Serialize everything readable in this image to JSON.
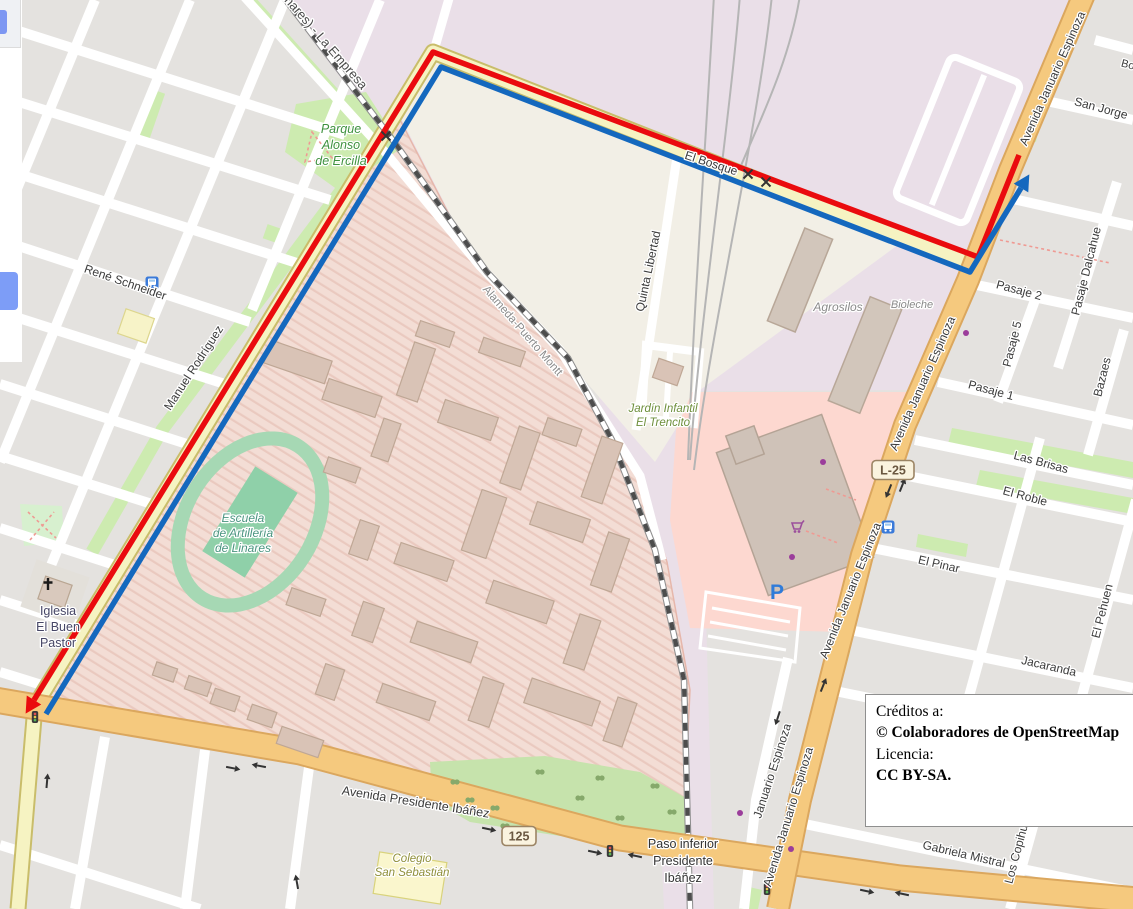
{
  "page": {
    "width": 1133,
    "height": 909,
    "description": "OpenStreetMap route map, Linares, Chile"
  },
  "credits": {
    "line1": "Créditos a:",
    "line2": "© Colaboradores de OpenStreetMap",
    "line3": "Licencia:",
    "line4": "CC BY-SA."
  },
  "map": {
    "palette": {
      "route_outbound_blue": "#1468be",
      "route_return_red": "#ea0b0e",
      "road_primary_orange": "#f5c97e",
      "road_secondary_yellow": "#f6f3c2",
      "grass_green": "#cdebb0",
      "military_pink": "#f3ddd5",
      "retail_pink": "#fdd8d0",
      "railway_lavender": "#eadfe8",
      "commercial_beige": "#f2efe6",
      "block_gray": "#e4e2df"
    },
    "route": {
      "red_points": [
        [
          1019,
          155
        ],
        [
          978,
          257
        ],
        [
          433,
          52
        ],
        [
          34,
          700
        ]
      ],
      "blue_points": [
        [
          46,
          714
        ],
        [
          441,
          67
        ],
        [
          970,
          272
        ],
        [
          1021,
          188
        ]
      ],
      "red_arrow_end": true,
      "blue_arrow_end": true,
      "stroke_width": 5.5
    },
    "shields": [
      {
        "label": "125",
        "x": 519,
        "y": 836
      },
      {
        "label": "L-25",
        "x": 893,
        "y": 470
      }
    ],
    "labels": [
      {
        "name": "railway-la-empresa",
        "lines": [
          "(Linares) - La Empresa"
        ],
        "x": 318,
        "y": 40,
        "rot": 49,
        "size": 13,
        "color": "#4a4a4a"
      },
      {
        "name": "street-rene-schneider",
        "lines": [
          "René Schneider"
        ],
        "x": 124,
        "y": 286,
        "rot": 19,
        "size": 12,
        "color": "#3c3c3c"
      },
      {
        "name": "street-manuel-rodriguez",
        "lines": [
          "Manuel Rodríguez"
        ],
        "x": 197,
        "y": 370,
        "rot": -57,
        "size": 12,
        "color": "#3c3c3c"
      },
      {
        "name": "park-alonso-de-ercilla",
        "lines": [
          "Parque",
          "Alonso",
          "de Ercilla"
        ],
        "x": 341,
        "y": 133,
        "rot": 0,
        "size": 12.5,
        "color": "#3f923f",
        "italic": true,
        "lh": 16
      },
      {
        "name": "street-el-bosque",
        "lines": [
          "El Bosque"
        ],
        "x": 710,
        "y": 167,
        "rot": 18,
        "size": 12,
        "color": "#3c3c3c"
      },
      {
        "name": "street-quinta-libertad",
        "lines": [
          "Quinta Libertad"
        ],
        "x": 652,
        "y": 272,
        "rot": -78,
        "size": 12,
        "color": "#3c3c3c"
      },
      {
        "name": "street-alameda-puerto-montt",
        "lines": [
          "Alameda-Puerto Montt"
        ],
        "x": 520,
        "y": 333,
        "rot": 49,
        "size": 11.5,
        "color": "#8a8a8a"
      },
      {
        "name": "poi-jardin-infantil",
        "lines": [
          "Jardín Infantil",
          "El Trencito"
        ],
        "x": 663,
        "y": 412,
        "rot": 0,
        "size": 11.5,
        "color": "#6e8f3c",
        "italic": true,
        "lh": 14
      },
      {
        "name": "poi-agrosilos",
        "lines": [
          "Agrosilos"
        ],
        "x": 838,
        "y": 311,
        "rot": 0,
        "size": 12,
        "color": "#8a8a8a",
        "italic": true
      },
      {
        "name": "poi-bioleche",
        "lines": [
          "Bioleche"
        ],
        "x": 912,
        "y": 308,
        "rot": 0,
        "size": 11,
        "color": "#8a8a8a",
        "italic": true
      },
      {
        "name": "poi-escuela-artilleria",
        "lines": [
          "Escuela",
          "de Artillería",
          "de Linares"
        ],
        "x": 243,
        "y": 522,
        "rot": 0,
        "size": 12,
        "color": "#4a9580",
        "italic": true,
        "lh": 15
      },
      {
        "name": "poi-iglesia-buen-pastor",
        "lines": [
          "Iglesia",
          "El Buen",
          "Pastor"
        ],
        "x": 58,
        "y": 615,
        "rot": 0,
        "size": 12.5,
        "color": "#464666",
        "lh": 16
      },
      {
        "name": "avenue-januario-espinoza-top",
        "lines": [
          "Avenida Januario Espinoza"
        ],
        "x": 1056,
        "y": 80,
        "rot": -66,
        "size": 12,
        "color": "#3c3c3c"
      },
      {
        "name": "avenue-januario-espinoza-mid",
        "lines": [
          "Avenida Januario Espinoza"
        ],
        "x": 926,
        "y": 385,
        "rot": -66,
        "size": 12,
        "color": "#3c3c3c"
      },
      {
        "name": "avenue-januario-espinoza-low",
        "lines": [
          "Avenida Januario Espinoza"
        ],
        "x": 854,
        "y": 592,
        "rot": -68,
        "size": 12,
        "color": "#3c3c3c"
      },
      {
        "name": "avenue-januario-espinoza-bottom",
        "lines": [
          "Avenida Januario Espinoza"
        ],
        "x": 792,
        "y": 818,
        "rot": -73,
        "size": 12,
        "color": "#3c3c3c"
      },
      {
        "name": "street-januario-espinoza",
        "lines": [
          "Januario Espinoza"
        ],
        "x": 776,
        "y": 772,
        "rot": -72,
        "size": 12,
        "color": "#3c3c3c"
      },
      {
        "name": "street-san-jorge",
        "lines": [
          "San Jorge"
        ],
        "x": 1100,
        "y": 112,
        "rot": 15,
        "size": 12,
        "color": "#3c3c3c"
      },
      {
        "name": "street-bo-cut",
        "lines": [
          "Bo"
        ],
        "x": 1127,
        "y": 68,
        "rot": 15,
        "size": 11,
        "color": "#3c3c3c"
      },
      {
        "name": "street-pasaje-2",
        "lines": [
          "Pasaje 2"
        ],
        "x": 1018,
        "y": 294,
        "rot": 15,
        "size": 12,
        "color": "#3c3c3c"
      },
      {
        "name": "street-pasaje-5",
        "lines": [
          "Pasaje 5"
        ],
        "x": 1016,
        "y": 345,
        "rot": -76,
        "size": 12,
        "color": "#3c3c3c"
      },
      {
        "name": "street-pasaje-1",
        "lines": [
          "Pasaje 1"
        ],
        "x": 990,
        "y": 394,
        "rot": 15,
        "size": 12,
        "color": "#3c3c3c"
      },
      {
        "name": "street-pasaje-dalcahue",
        "lines": [
          "Pasaje Dalcahue"
        ],
        "x": 1090,
        "y": 272,
        "rot": -76,
        "size": 12,
        "color": "#3c3c3c"
      },
      {
        "name": "street-bazaes",
        "lines": [
          "Bazaes"
        ],
        "x": 1106,
        "y": 378,
        "rot": -76,
        "size": 12,
        "color": "#3c3c3c"
      },
      {
        "name": "street-las-brisas",
        "lines": [
          "Las Brisas"
        ],
        "x": 1040,
        "y": 466,
        "rot": 15,
        "size": 12,
        "color": "#3c3c3c"
      },
      {
        "name": "street-el-roble",
        "lines": [
          "El Roble"
        ],
        "x": 1024,
        "y": 500,
        "rot": 15,
        "size": 12,
        "color": "#3c3c3c"
      },
      {
        "name": "street-el-pinar",
        "lines": [
          "El Pinar"
        ],
        "x": 938,
        "y": 568,
        "rot": 13,
        "size": 12,
        "color": "#3c3c3c"
      },
      {
        "name": "street-el-pehuen",
        "lines": [
          "El Pehuen"
        ],
        "x": 1106,
        "y": 612,
        "rot": -76,
        "size": 12,
        "color": "#3c3c3c"
      },
      {
        "name": "street-jacaranda",
        "lines": [
          "Jacaranda"
        ],
        "x": 1048,
        "y": 670,
        "rot": 13,
        "size": 12,
        "color": "#3c3c3c"
      },
      {
        "name": "street-gabriela-mistral",
        "lines": [
          "Gabriela Mistral"
        ],
        "x": 963,
        "y": 858,
        "rot": 13,
        "size": 12,
        "color": "#3c3c3c"
      },
      {
        "name": "street-los-copihues-cut",
        "lines": [
          "Los Copihu"
        ],
        "x": 1020,
        "y": 855,
        "rot": -75,
        "size": 12,
        "color": "#3c3c3c"
      },
      {
        "name": "avenue-presidente-ibanez",
        "lines": [
          "Avenida Presidente Ibáñez"
        ],
        "x": 415,
        "y": 806,
        "rot": 9,
        "size": 12.5,
        "color": "#3c3c3c"
      },
      {
        "name": "poi-paso-inferior",
        "lines": [
          "Paso inferior",
          "Presidente",
          "Ibáñez"
        ],
        "x": 683,
        "y": 848,
        "rot": 0,
        "size": 12.5,
        "color": "#333333",
        "lh": 17
      },
      {
        "name": "poi-colegio-san-sebastian",
        "lines": [
          "Colegio",
          "San Sebastián"
        ],
        "x": 412,
        "y": 862,
        "rot": 0,
        "size": 11.5,
        "color": "#8f8f3a",
        "italic": true,
        "lh": 14
      }
    ],
    "icons": [
      {
        "type": "bus-stop",
        "x": 152,
        "y": 283
      },
      {
        "type": "bus-stop",
        "x": 888,
        "y": 527
      },
      {
        "type": "traffic-light",
        "x": 35,
        "y": 717
      },
      {
        "type": "traffic-light",
        "x": 610,
        "y": 851
      },
      {
        "type": "traffic-light",
        "x": 767,
        "y": 889
      },
      {
        "type": "level-crossing",
        "x": 386,
        "y": 136
      },
      {
        "type": "level-crossing",
        "x": 748,
        "y": 174
      },
      {
        "type": "level-crossing",
        "x": 766,
        "y": 182
      },
      {
        "type": "church-cross",
        "x": 48,
        "y": 586
      },
      {
        "type": "parking",
        "x": 777,
        "y": 592
      },
      {
        "type": "shopping-cart",
        "x": 797,
        "y": 527
      },
      {
        "type": "oneway-arrow",
        "x": 232,
        "y": 768,
        "rot": 11
      },
      {
        "type": "oneway-arrow",
        "x": 260,
        "y": 766,
        "rot": 191
      },
      {
        "type": "oneway-arrow",
        "x": 488,
        "y": 829,
        "rot": 12
      },
      {
        "type": "oneway-arrow",
        "x": 594,
        "y": 852,
        "rot": 12
      },
      {
        "type": "oneway-arrow",
        "x": 636,
        "y": 856,
        "rot": 192
      },
      {
        "type": "oneway-arrow",
        "x": 866,
        "y": 891,
        "rot": 12
      },
      {
        "type": "oneway-arrow",
        "x": 903,
        "y": 894,
        "rot": 192
      },
      {
        "type": "oneway-arrow",
        "x": 889,
        "y": 490,
        "rot": 112
      },
      {
        "type": "oneway-arrow",
        "x": 902,
        "y": 486,
        "rot": -68
      },
      {
        "type": "oneway-arrow",
        "x": 778,
        "y": 717,
        "rot": 108
      },
      {
        "type": "oneway-arrow",
        "x": 823,
        "y": 686,
        "rot": -68
      },
      {
        "type": "oneway-arrow",
        "x": 47,
        "y": 782,
        "rot": -85
      },
      {
        "type": "oneway-arrow",
        "x": 297,
        "y": 883,
        "rot": -100
      }
    ],
    "dots": [
      {
        "x": 966,
        "y": 333
      },
      {
        "x": 823,
        "y": 462
      },
      {
        "x": 792,
        "y": 557
      },
      {
        "x": 740,
        "y": 813
      },
      {
        "x": 791,
        "y": 849
      }
    ]
  }
}
